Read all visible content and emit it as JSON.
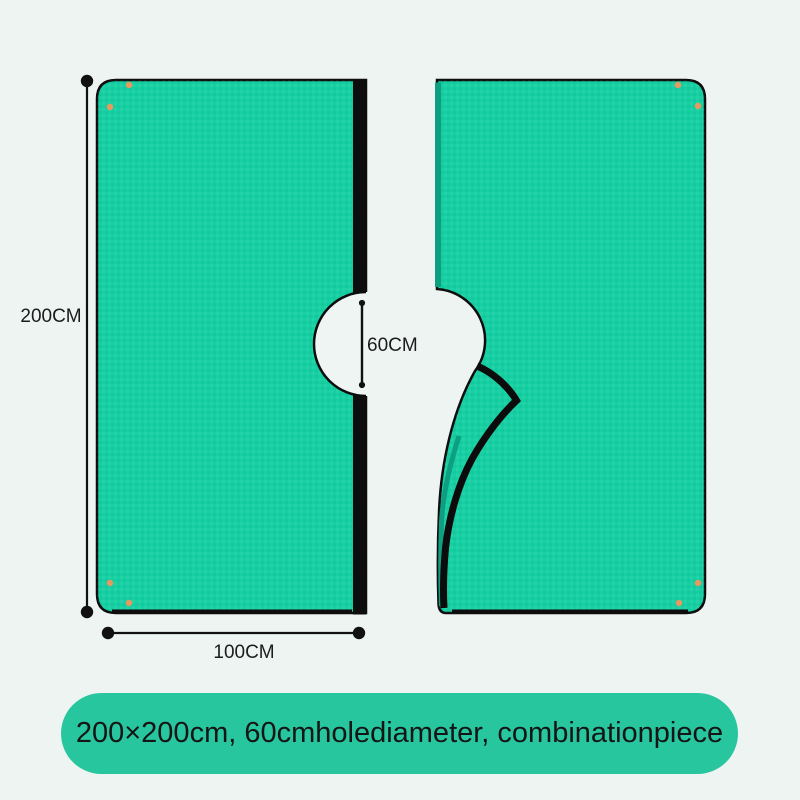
{
  "dimension_labels": {
    "height": "200CM",
    "width": "100CM",
    "hole_diameter": "60CM"
  },
  "banner": {
    "text": "200×200cm,  60cmholediameter,  combinationpiece",
    "background": "#27c69e",
    "text_color": "#151515"
  },
  "colors": {
    "background": "#edf4f2",
    "sheet": "#16cfa2",
    "sheet_edge_dark": "#0e9f82",
    "trim_black": "#0d0d0d",
    "snap_dot": "#e8995f",
    "hole_white": "#eff5f3"
  }
}
